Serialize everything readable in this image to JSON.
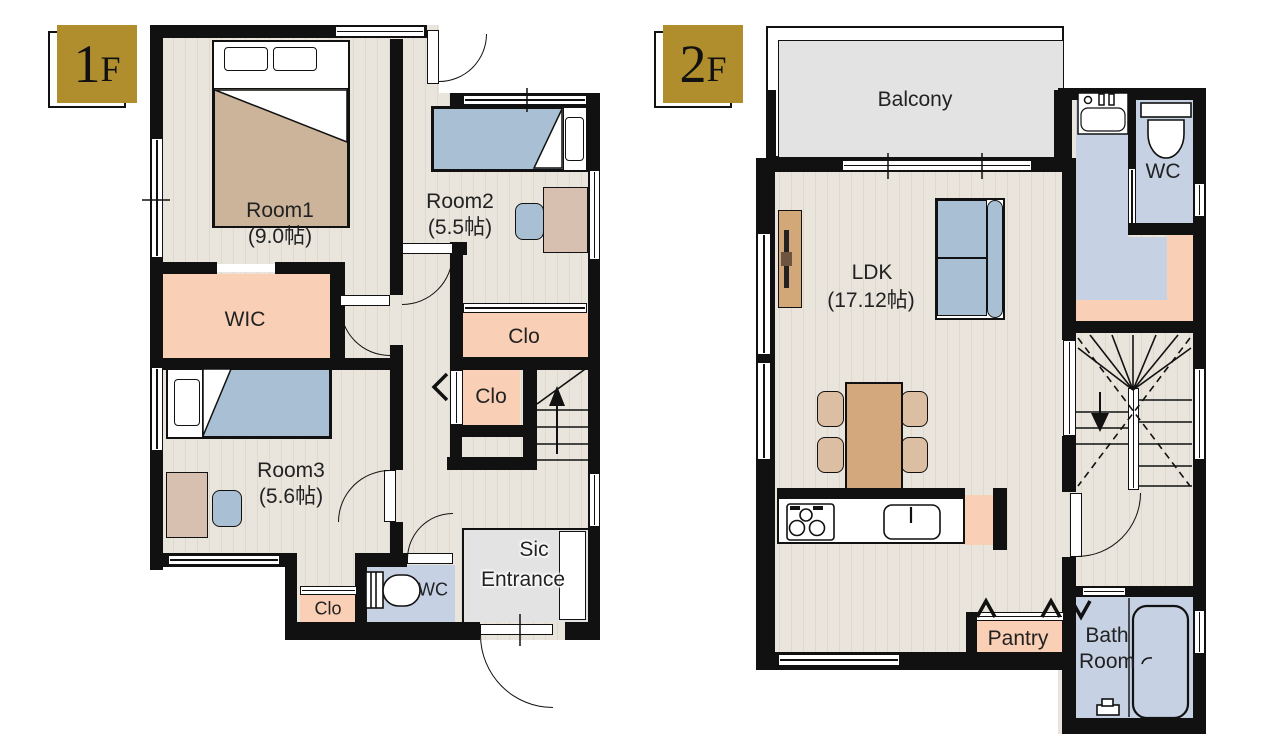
{
  "colors": {
    "accent_gold": "#b08e2d",
    "wall": "#111111",
    "floor_beige": "#e9e5dc",
    "closet_peach": "#f9cfb6",
    "wet_area_blue": "#c6d2e4",
    "balcony_gray": "#e3e3e3"
  },
  "f1": {
    "badge": {
      "num": "1",
      "suffix": "F"
    },
    "labels": {
      "room1": "Room1",
      "room1_size": "(9.0帖)",
      "room2": "Room2",
      "room2_size": "(5.5帖)",
      "room3": "Room3",
      "room3_size": "(5.6帖)",
      "wic": "WIC",
      "clo_room2": "Clo",
      "clo_hall": "Clo",
      "clo_room3": "Clo",
      "wc": "WC",
      "sic": "Sic",
      "entrance": "Entrance"
    }
  },
  "f2": {
    "badge": {
      "num": "2",
      "suffix": "F"
    },
    "labels": {
      "balcony": "Balcony",
      "ldk": "LDK",
      "ldk_size": "(17.12帖)",
      "wc": "WC",
      "pantry": "Pantry",
      "bath_line1": "Bath",
      "bath_line2": "Room"
    }
  }
}
